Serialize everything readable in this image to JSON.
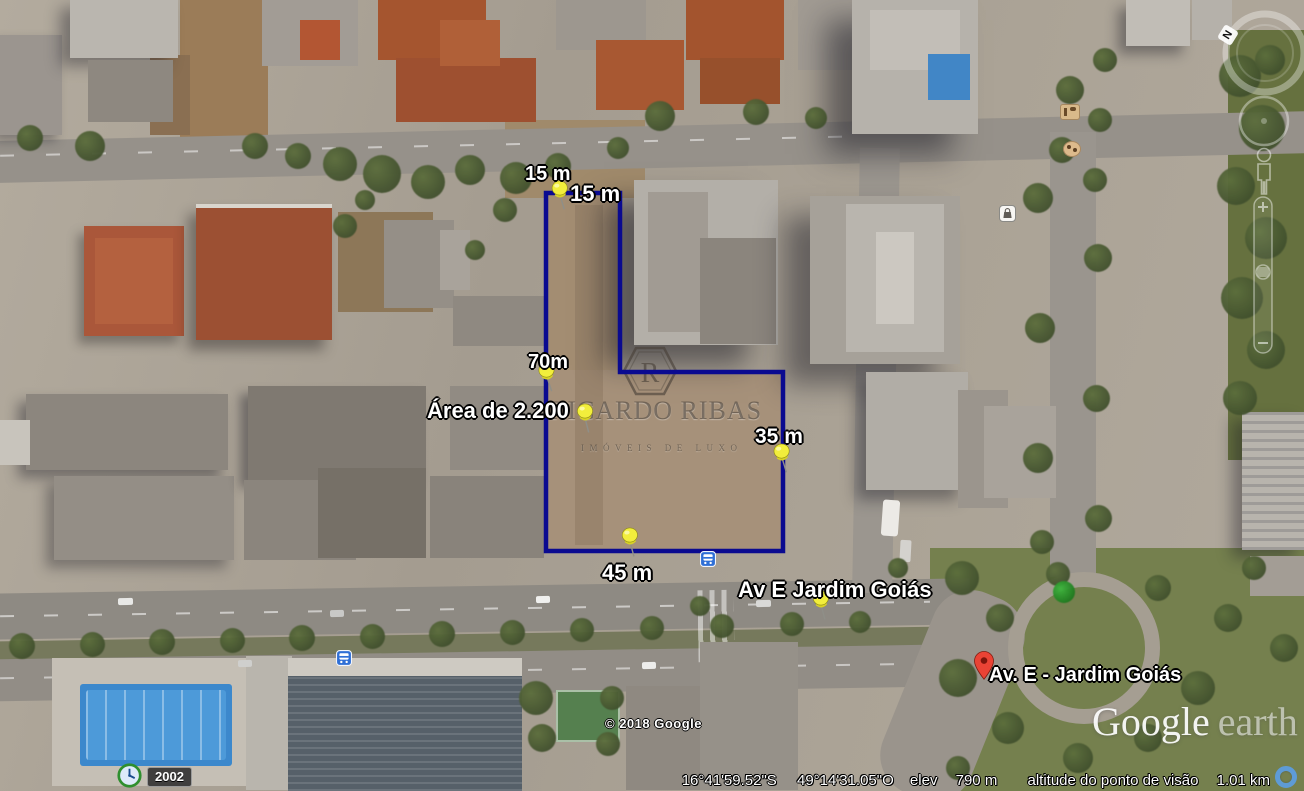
{
  "annotations": {
    "measurements": {
      "top_outer": "15 m",
      "top_inner": "15 m",
      "left": "70m",
      "right": "35 m",
      "bottom": "45 m"
    },
    "area_label": "Área de 2.200",
    "street_label": "Av E Jardim Goiás",
    "placemark": "Av. E - Jardim Goiás"
  },
  "watermark": {
    "logo_letter": "R",
    "brand": "RICARDO RIBAS",
    "tagline": "IMÓVEIS DE LUXO"
  },
  "attribution": {
    "copyright": "© 2018 Google",
    "logo_primary": "Google",
    "logo_secondary": "earth"
  },
  "status_bar": {
    "latitude": "16°41'59.52\"S",
    "longitude": "49°14'31.05\"O",
    "elevation_label": "elev",
    "elevation_value": "790 m",
    "eye_altitude_label": "altitude do ponto de visão",
    "eye_altitude_value": "1.01 km"
  },
  "timeline": {
    "year": "2002"
  },
  "navigation": {
    "north_indicator": "N"
  },
  "icons": {
    "pushpin": "yellow-pushpin",
    "placemark": "red-map-pin",
    "bus_stop": "blue-bus-square",
    "shopping": "white-bag-square",
    "clock": "historical-imagery-clock",
    "streaming": "blue-progress-ring"
  },
  "colors": {
    "boundary_stroke": "#0a0a90",
    "pin_yellow": "#f2ee3c",
    "marker_red": "#ea4335",
    "bus_icon_blue": "#2f6fd6",
    "pool_blue": "#3c88cc"
  }
}
